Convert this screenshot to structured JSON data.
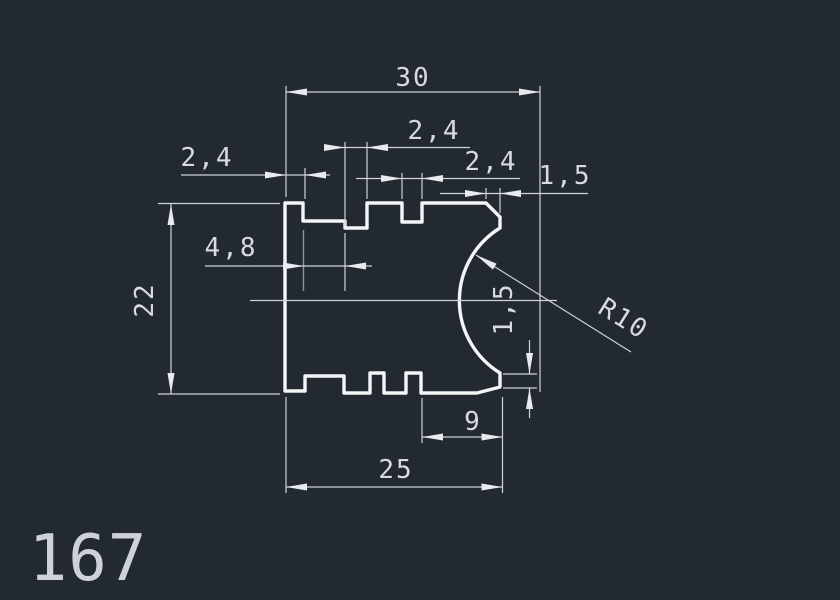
{
  "canvas": {
    "background": "#232931",
    "outline_color": "#f3f5f6",
    "dimension_color": "#ced3d7",
    "text_color": "#d7dbde"
  },
  "drawing": {
    "part_number": "167",
    "view": "profile-cross-section"
  },
  "dims": {
    "width_to_arc_center": "30",
    "overall_height": "22",
    "top_left_tooth": "2,4",
    "top_slot_1": "2,4",
    "top_slot_2": "2,4",
    "top_ledge": "4,8",
    "top_chamfer": "1,5",
    "right_face": "1,5",
    "bottom_notch_to_edge": "9",
    "base_width": "25",
    "arc_radius": "R10"
  }
}
